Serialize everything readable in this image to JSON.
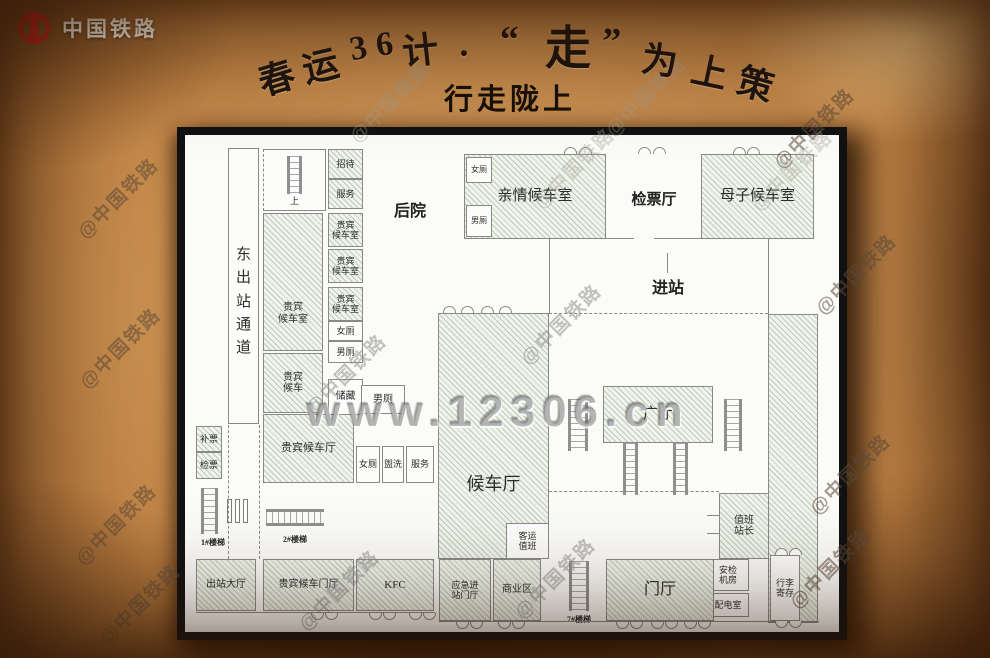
{
  "brand": {
    "name": "中国铁路"
  },
  "title": {
    "chars": [
      "春",
      "运",
      "3",
      "6",
      "计",
      "·",
      "“",
      "走",
      "”",
      "为",
      "上",
      "策"
    ],
    "subtitle": "行走陇上"
  },
  "watermark": {
    "text": "@中国铁路",
    "site": "www.12306.cn"
  },
  "colors": {
    "logo_red": "#c9231a",
    "parchment": "#c08244",
    "plan_bg": "#fbfbf8",
    "wall": "#8a8a85",
    "hatch": "#7d987d"
  },
  "plan": {
    "rooms": {
      "east_exit": "东\n出\n站\n通\n道",
      "up": "上",
      "zhaodai": "招待",
      "fuwu_top": "服务",
      "vip_room_a": "贵宾\n候车室",
      "vip_wait": "贵宾\n候车",
      "vip_room_b": "贵宾\n候车室",
      "vip_room_c": "贵宾\n候车室",
      "vip_room_d": "贵宾\n候车室",
      "nvce_mid": "女厕",
      "nance_mid": "男厕",
      "chucang": "储藏",
      "nance_2": "男厕",
      "vip_hall": "贵宾候车厅",
      "nvce_row": "女厕",
      "guanxi": "盥洗",
      "fuwu_row": "服务",
      "bupiao": "补票",
      "jianpiao": "检票",
      "stair1": "1#楼梯",
      "stair2": "2#楼梯",
      "stair7": "7#楼梯",
      "exit_hall": "出站大厅",
      "vip_foyer": "贵宾候车门厅",
      "kfc": "KFC",
      "houyuan": "后院",
      "nvce_qq": "女厕",
      "nance_qq": "男厕",
      "qinqing": "亲情候车室",
      "jianpiao_hall": "检票厅",
      "muzi": "母子候车室",
      "jinzhan": "进站",
      "waiting_hall": "候车厅",
      "keyun": "客运\n值班",
      "guangting": "广厅",
      "yingji": "应急进\n站门厅",
      "shangye": "商业区",
      "menting": "门厅",
      "zhiban": "值班\n站长",
      "anjian": "安检\n机房",
      "peidian": "配电室",
      "xingli": "行李\n寄存"
    }
  }
}
